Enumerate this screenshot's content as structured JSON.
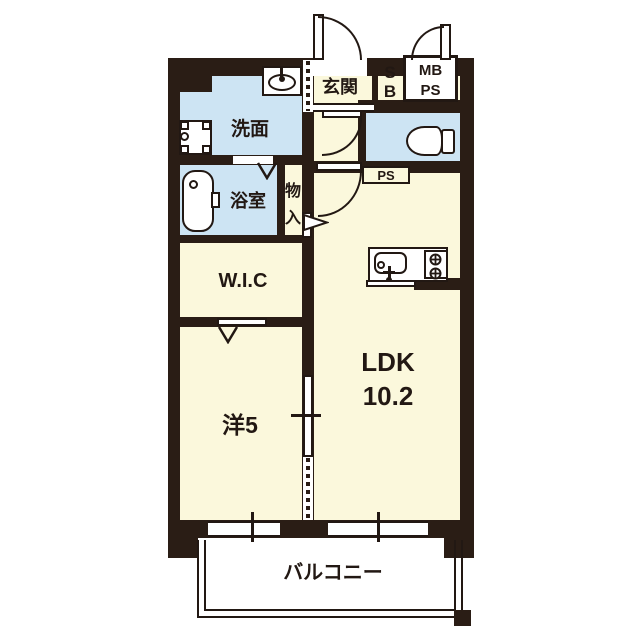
{
  "type": "apartment-floor-plan",
  "palette": {
    "wall": "#2a1d15",
    "line": "#221813",
    "room_floor": "#fbf8dc",
    "wet_room_floor": "#cde4f3",
    "background": "#ffffff"
  },
  "rooms": {
    "genkan": {
      "label": "玄関"
    },
    "shoe_box": {
      "line1": "S",
      "line2": "B"
    },
    "meter_pipe": {
      "line1": "MB",
      "line2": "PS"
    },
    "washroom": {
      "label": "洗面"
    },
    "bathroom": {
      "label": "浴室"
    },
    "storage": {
      "char1": "物",
      "char2": "入"
    },
    "pipe_space": {
      "label": "PS"
    },
    "wic": {
      "label": "W.I.C"
    },
    "western_room": {
      "label": "洋5"
    },
    "ldk": {
      "line1": "LDK",
      "line2": "10.2"
    },
    "balcony": {
      "label": "バルコニー"
    }
  },
  "icons": [
    "entrance-door-icon",
    "meter-box-door-icon",
    "toilet-door-icon",
    "ldk-door-icon",
    "storage-door-swing-icon",
    "folding-door-icon",
    "sliding-door-icon",
    "vanity-sink-icon",
    "washing-machine-pan-icon",
    "bathtub-icon",
    "toilet-icon",
    "kitchen-sink-icon",
    "gas-stove-icon",
    "window-icon"
  ]
}
